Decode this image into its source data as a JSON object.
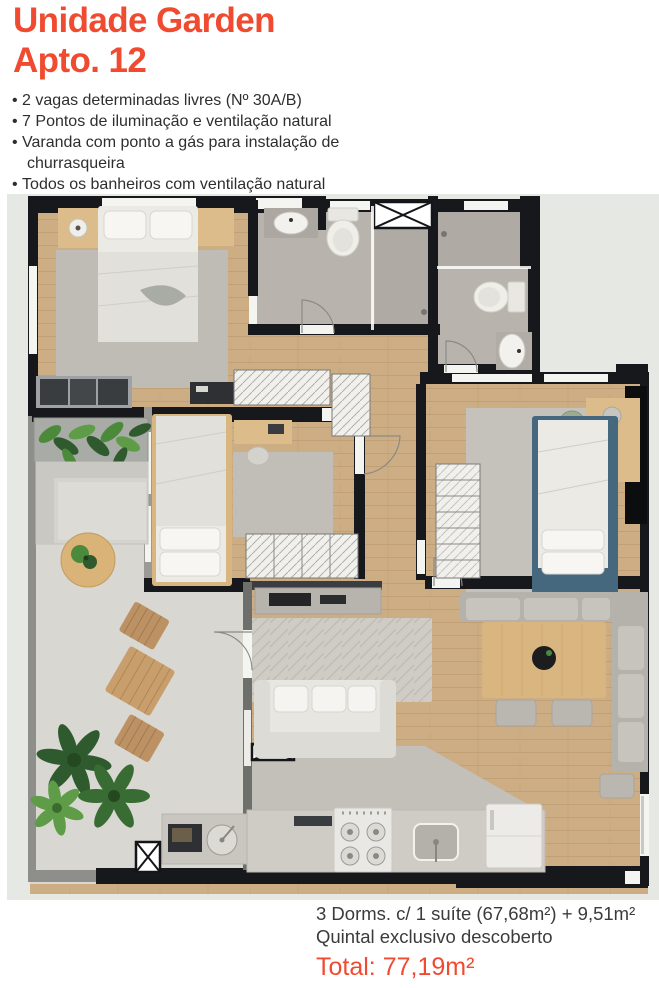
{
  "header": {
    "title_line1": "Unidade Garden",
    "title_line2": "Apto. 12"
  },
  "features": [
    "2 vagas determinadas livres (Nº 30A/B)",
    "7 Pontos de iluminação e ventilação natural",
    "Varanda com ponto a gás para instalação de churrasqueira",
    "Todos os banheiros com ventilação natural"
  ],
  "footer": {
    "line1": "3 Dorms. c/ 1 suíte (67,68m²) + 9,51m²",
    "line2": "Quintal exclusivo descoberto",
    "total": "Total: 77,19m²"
  },
  "colors": {
    "accent_orange": "#F04B30",
    "body_text": "#2E2E2E",
    "footer_text": "#3B3B3B",
    "wall_dark": "#17181B",
    "exterior_ground": "#E6E8E3",
    "wood_floor": "#CDAD83",
    "bathroom_tile": "#B8B4AD",
    "patio_concrete": "#D8D7D2",
    "bedroom3_blue": "#46687F",
    "plant_green": "#4C8A3B"
  }
}
